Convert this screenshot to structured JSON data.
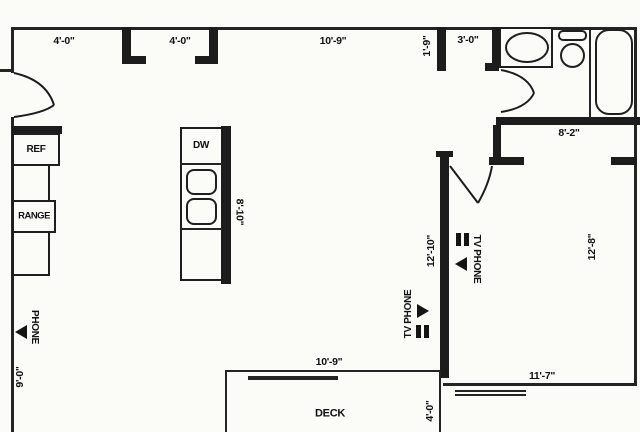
{
  "plan": {
    "colors": {
      "line": "#1c1c1c",
      "background": "#fbfbf8"
    },
    "dimensions": {
      "top_window_left": "4'-0\"",
      "top_opening": "4'-0\"",
      "top_window_main": "10'-9\"",
      "wall_stub": "1'-9\"",
      "bath_hall": "3'-0\"",
      "bedroom_closet_wall": "8'-2\"",
      "island_length": "8'-10\"",
      "living_wall": "12'-10\"",
      "bedroom_width": "12'-8\"",
      "kitchen_wall": "9'-0\"",
      "deck_width": "10'-9\"",
      "bedroom_window": "11'-7\"",
      "deck_depth": "4'-0\""
    },
    "fixtures": {
      "refrigerator": "REF",
      "range": "RANGE",
      "dishwasher": "DW",
      "deck": "DECK"
    },
    "outlets": {
      "phone": "PHONE",
      "tv_phone_living": "TV PHONE",
      "tv_phone_bedroom": "TV PHONE"
    }
  }
}
